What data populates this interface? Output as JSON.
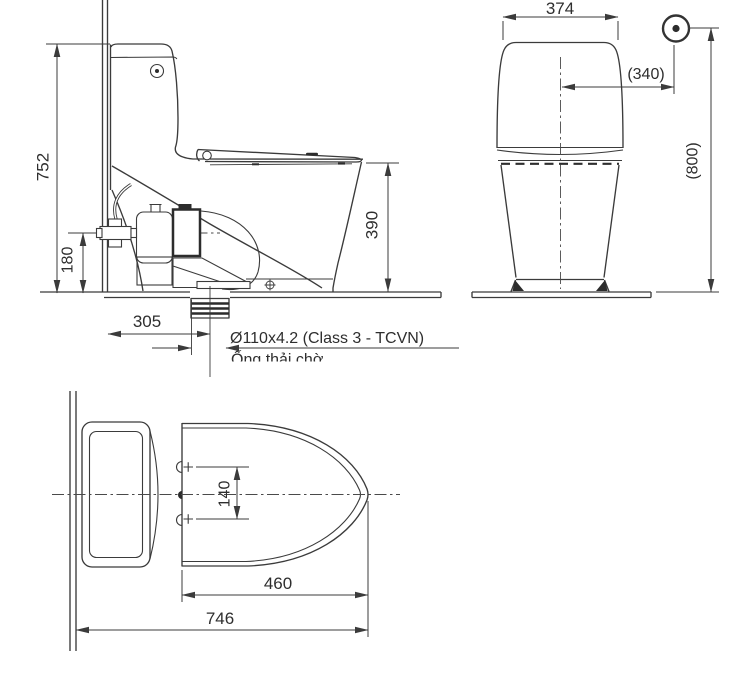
{
  "drawing": {
    "kind": "technical-dimension-diagram",
    "background": "#ffffff",
    "line_color": "#3b3b3b",
    "text_color": "#2e2e2e",
    "views": {
      "side": {
        "label": "side elevation",
        "dimensions": {
          "overall_height": "752",
          "inlet_height": "180",
          "rim_height": "390",
          "trap_offset": "305"
        },
        "callout": {
          "pipe_spec": "Ø110x4.2 (Class 3 - TCVN)",
          "pipe_label": "Ống thải chờ"
        }
      },
      "front": {
        "label": "front elevation",
        "dimensions": {
          "tank_width": "374",
          "supply_offset": "(340)",
          "supply_height": "(800)"
        }
      },
      "plan": {
        "label": "top plan",
        "dimensions": {
          "hinge_hole_spacing": "140",
          "bowl_length": "460",
          "overall_depth": "746"
        }
      }
    }
  }
}
